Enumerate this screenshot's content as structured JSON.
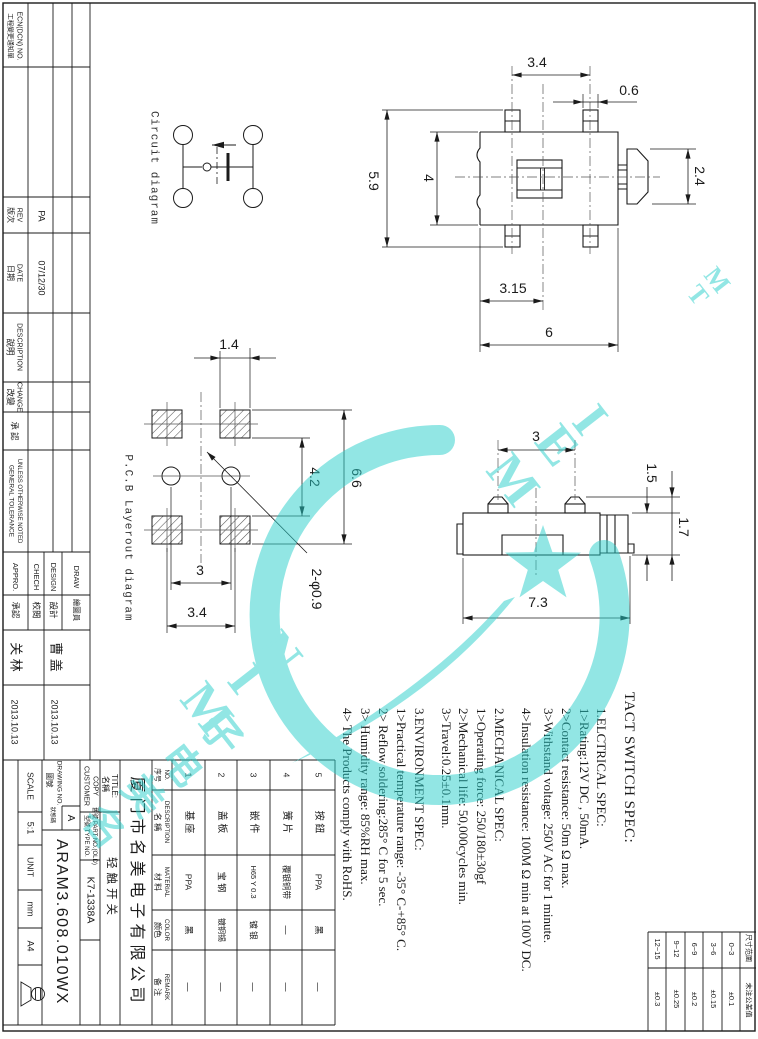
{
  "revision": {
    "ecn_zh": "工程變更通知單",
    "ecn_en": "ECN(DCN) NO.",
    "rev_zh": "版次",
    "rev_en": "REV",
    "rev_value": "PA",
    "date_zh": "日期",
    "date_en": "DATE",
    "date_value": "07/12/30",
    "desc_zh": "說明",
    "desc_en": "DESCRIPTION",
    "change_zh": "改變",
    "change_en": "CHANGE",
    "approve_zh": "承 認",
    "tol1": "GENERAL TOLERANCE",
    "tol2": "UNLESS OTHERWISE NOTED"
  },
  "signatures": {
    "draw_en": "DRAW",
    "draw_zh": "繪圖員",
    "design_en": "DESIGN",
    "design_zh": "設計",
    "check_en": "CHECH",
    "check_zh": "校閱",
    "appro_en": "APPRO.",
    "appro_zh": "承認",
    "name_draw": "曹 盖",
    "name_appro": "关 林",
    "date_draw": "2013.10.13",
    "date_appro": "2013.10.13"
  },
  "title_block": {
    "scale_label": "SCALE",
    "scale_value": "5:1",
    "unit_label": "UNIT",
    "unit_value": "mm",
    "sheet": "A4",
    "drawing_no_zh": "圖號",
    "drawing_no_en": "DRAWING NO.",
    "status_zh": "狀態碼",
    "status_value": "A",
    "drawing_no_value": "ARAM3.608.010WX",
    "customer1": "CUSTOMER",
    "customer2": "COPY",
    "type_label": "型號 TYPE NO.",
    "part_old_label": "舊號 PART NO.(OLD)",
    "type_value": "K7-1338A",
    "title_zh": "名稱",
    "title_en": "TITLE:",
    "title_value": "轻触开关"
  },
  "company": "厦门市名美电子有限公司",
  "bom": {
    "h": {
      "no_zh": "序号",
      "no_en": "NO.",
      "desc_zh": "名 稱",
      "desc_en": "DESCRIPTION",
      "mat_zh": "材 料",
      "mat_en": "MATERIAL",
      "color_zh": "颜色",
      "color_en": "COLOR",
      "rem_zh": "备 注",
      "rem_en": "REMARK"
    },
    "rows": [
      {
        "no": "1",
        "desc": "基 座",
        "mat": "PPA",
        "color": "黑",
        "rem": "—"
      },
      {
        "no": "2",
        "desc": "盖 板",
        "mat": "宝 钢",
        "color": "镀铜锡",
        "rem": "—"
      },
      {
        "no": "3",
        "desc": "嵌 件",
        "mat": "H65 Y 0.3",
        "color": "镀 银",
        "rem": "—"
      },
      {
        "no": "4",
        "desc": "簧 片",
        "mat": "覆银铜带",
        "color": "—",
        "rem": "—"
      },
      {
        "no": "5",
        "desc": "按 鈕",
        "mat": "PPA",
        "color": "黑",
        "rem": "—"
      }
    ]
  },
  "specs": {
    "title": "TACT SWITCH SPEC:",
    "lines": [
      "1.ELCTRICAL SPEC:",
      "1>Rating:12V  DC , 50mA.",
      "2>Contact resistance:  50m Ω  max.",
      "3>Withstand  voltage:  250V AC for 1 minute.",
      "4>Insulation  resistance:  100M Ω min at 100V DC.",
      "2.MECHANICAL SPEC:",
      "1>Operating force:  250/180±30gf",
      "2>Mechanical life:  50,000cycles min.",
      "3>Travel:0.25±0.1mm.",
      "3.ENVIRONMENT SPEC:",
      "1>Practical temperature range:  -35° C-+85° C.",
      "2> Reflow soldering:285° C for 5 sec.",
      "3> Humidity range:  85%RH max.",
      "4> The Products comply with RoHS."
    ]
  },
  "tolerance": {
    "h_range": "尺寸范圍",
    "h_tol": "未注公差值",
    "rows": [
      {
        "range": "0~3",
        "tol": "±0.1"
      },
      {
        "range": "3~6",
        "tol": "±0.15"
      },
      {
        "range": "6~9",
        "tol": "±0.2"
      },
      {
        "range": "9~12",
        "tol": "±0.25"
      },
      {
        "range": "12~15",
        "tol": "±0.3"
      }
    ]
  },
  "views": {
    "circuit_label": "Circuit diagram",
    "pcb_label": "P.C.B Layerout diagram",
    "top": {
      "d1": "3.4",
      "d2": "0.6",
      "d3": "4",
      "d4": "5.9",
      "d5": "2.4",
      "d6": "3.15",
      "d7": "6"
    },
    "pcb": {
      "d1": "1.4",
      "d2": "4.2",
      "d3": "6.6",
      "d4": "3",
      "d5": "3.4",
      "d6": "2-φ0.9"
    },
    "side": {
      "d1": "3",
      "d2": "1.5",
      "d3": "1.7",
      "d4": "7.3"
    }
  },
  "watermark": {
    "word1": "MIN",
    "word2": "MEI",
    "tm": "TM",
    "zh": "名美电子"
  }
}
